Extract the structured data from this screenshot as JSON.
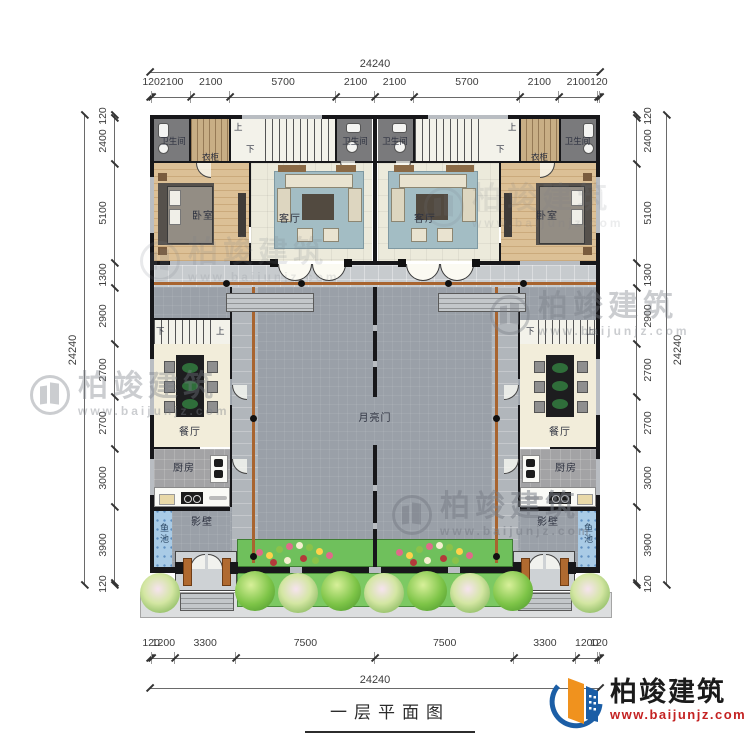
{
  "title": "一层平面图",
  "brand": {
    "name": "柏竣建筑",
    "url": "www.baijunjz.com"
  },
  "watermark": {
    "name": "柏竣建筑",
    "url": "www.baijunjz.com"
  },
  "dimensions": {
    "top": {
      "total": "24240",
      "segments": [
        "120",
        "2100",
        "2100",
        "5700",
        "2100",
        "2100",
        "5700",
        "2100",
        "2100",
        "120"
      ]
    },
    "bottom": {
      "total": "24240",
      "segments": [
        "120",
        "1200",
        "3300",
        "7500",
        "7500",
        "3300",
        "1200",
        "120"
      ]
    },
    "left": {
      "total": "24240",
      "segments": [
        "120",
        "2400",
        "5100",
        "1300",
        "2900",
        "2700",
        "2700",
        "3000",
        "3900",
        "120"
      ]
    },
    "right": {
      "total": "24240",
      "segments": [
        "120",
        "2400",
        "5100",
        "1300",
        "2900",
        "2700",
        "2700",
        "3000",
        "3900",
        "120"
      ]
    }
  },
  "rooms": {
    "bathroom": "卫生间",
    "wardrobe": "衣柜",
    "bedroom": "卧室",
    "living_room": "客厅",
    "dining_room": "餐厅",
    "kitchen": "厨房",
    "moon_gate": "月亮门",
    "screen_wall": "影壁",
    "fish_pond": "鱼池",
    "stair_up": "上",
    "stair_down": "下"
  }
}
